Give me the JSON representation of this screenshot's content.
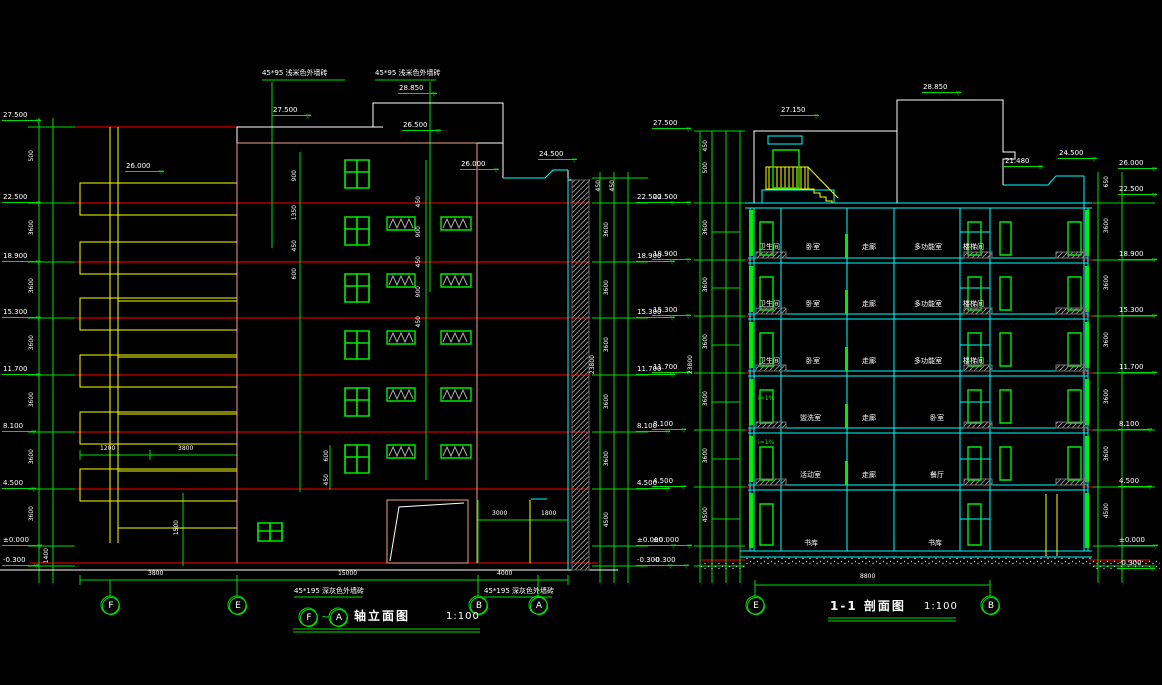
{
  "colors": {
    "background": "#000000",
    "line_green": "#00ee00",
    "line_red": "#ff0000",
    "line_yellow": "#ffff00",
    "line_cyan": "#00ffff",
    "line_white": "#ffffff",
    "line_salmon": "#f2a08c",
    "hatch_gray": "#8a8a8a"
  },
  "elevation": {
    "title": {
      "axis_start": "F",
      "tilde": "~",
      "axis_end": "A",
      "name": "轴立面图",
      "scale": "1:100"
    },
    "notes": {
      "top1": "45*95 浅米色外墙砖",
      "top2": "45*95 浅米色外墙砖",
      "bottom1": "45*195 深灰色外墙砖",
      "bottom2": "45*195 深灰色外墙砖"
    },
    "levels_left": [
      "27.500",
      "22.500",
      "18.900",
      "15.300",
      "11.700",
      "8.100",
      "4.500",
      "±0.000",
      "-0.300"
    ],
    "levels_right": [
      "22.500",
      "18.900",
      "15.300",
      "11.700",
      "8.100",
      "4.500",
      "±0.000",
      "-0.300"
    ],
    "levels_top": {
      "parapet": "27.500",
      "bulkhead": "28.850",
      "upper": "26.500",
      "roof_left": "26.000",
      "roof_right": "24.500",
      "wing": "26.000"
    },
    "dims": {
      "left_col": [
        "500",
        "3600",
        "3600",
        "3600",
        "3600",
        "3600",
        "3600",
        "1400"
      ],
      "right_col": [
        "450",
        "450",
        "3600",
        "3600",
        "3600",
        "3600",
        "3600",
        "4500"
      ],
      "right_total": "23800",
      "window_col": [
        "900",
        "1350",
        "450",
        "600"
      ],
      "mid_col": [
        "450",
        "900",
        "450",
        "900",
        "450"
      ],
      "bottom_upper": [
        "1200",
        "3800"
      ],
      "bottom_entrance": [
        "3000",
        "1800"
      ],
      "bottom_main": [
        "3800",
        "15000",
        "4000"
      ],
      "misc": [
        "1500",
        "600",
        "450"
      ]
    },
    "axes": [
      "F",
      "E",
      "B",
      "A"
    ]
  },
  "section": {
    "title": {
      "name": "1-1 剖面图",
      "scale": "1:100"
    },
    "levels_left": [
      "27.500",
      "22.500",
      "18.900",
      "15.300",
      "11.700",
      "8.100",
      "4.500",
      "±0.000",
      "-0.300"
    ],
    "levels_right": [
      "26.000",
      "22.500",
      "18.900",
      "15.300",
      "11.700",
      "8.100",
      "4.500",
      "±0.000",
      "-0.300"
    ],
    "levels_top": {
      "bulkhead": "27.150",
      "roof": "28.850",
      "step": "24.500",
      "roof_low": "21.480"
    },
    "rooms": {
      "upper": [
        "卫生间",
        "卧室",
        "走廊",
        "多功能室",
        "楼梯间"
      ],
      "b4": [
        "盥洗室",
        "走廊",
        "卧室"
      ],
      "b5": [
        "活动室",
        "走廊",
        "餐厅"
      ],
      "b6": [
        "书库",
        "书库"
      ]
    },
    "dims": {
      "left_col": [
        "450",
        "500",
        "3600",
        "3600",
        "3600",
        "3600",
        "3600",
        "4500"
      ],
      "left_total": "23800",
      "right_col": [
        "650",
        "3600",
        "3600",
        "3600",
        "3600",
        "3600",
        "4500"
      ],
      "bottom": "8800"
    },
    "note_slope": "i=1%",
    "axes": [
      "E",
      "B"
    ]
  }
}
